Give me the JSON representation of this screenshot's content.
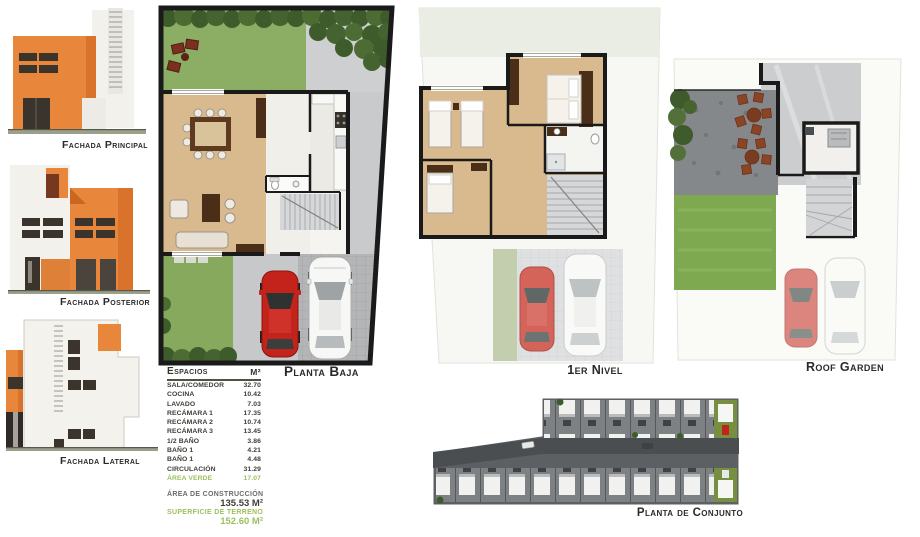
{
  "palette": {
    "accent_orange": "#E8873B",
    "orange_dark": "#C9661F",
    "window_dark": "#3B342C",
    "grass_green": "#8BAD64",
    "hedge_green": "#3E5C2B",
    "wood_floor": "#D8BA8E",
    "concrete_gray": "#C6C8CA",
    "car_red": "#C4231B",
    "wall_black": "#1A1A1A",
    "table_green_text": "#9CBF5F",
    "site_plan_gray": "#5C6062"
  },
  "facades": {
    "principal": {
      "label": "Fachada Principal"
    },
    "posterior": {
      "label": "Fachada Posterior"
    },
    "lateral": {
      "label": "Fachada Lateral"
    }
  },
  "plans": {
    "planta_baja": {
      "label": "Planta Baja"
    },
    "primer_nivel": {
      "label": "1er Nivel"
    },
    "roof_garden": {
      "label": "Roof Garden"
    },
    "conjunto": {
      "label": "Planta de Conjunto"
    }
  },
  "espacios": {
    "title": "Espacios",
    "unit": "M²",
    "rows": [
      {
        "name": "SALA/COMEDOR",
        "value": "32.70"
      },
      {
        "name": "COCINA",
        "value": "10.42"
      },
      {
        "name": "LAVADO",
        "value": "7.03"
      },
      {
        "name": "RECÁMARA 1",
        "value": "17.35"
      },
      {
        "name": "RECÁMARA 2",
        "value": "10.74"
      },
      {
        "name": "RECÁMARA 3",
        "value": "13.45"
      },
      {
        "name": "1/2 BAÑO",
        "value": "3.86"
      },
      {
        "name": "BAÑO 1",
        "value": "4.21"
      },
      {
        "name": "BAÑO 1",
        "value": "4.48"
      },
      {
        "name": "CIRCULACIÓN",
        "value": "31.29"
      },
      {
        "name": "ÁREA VERDE",
        "value": "17.07"
      }
    ],
    "totals": {
      "construccion": {
        "label": "ÁREA DE CONSTRUCCIÓN",
        "value": "135.53 M²"
      },
      "terreno": {
        "label": "SUPERFICIE DE TERRENO",
        "value": "152.60 M²"
      }
    }
  }
}
